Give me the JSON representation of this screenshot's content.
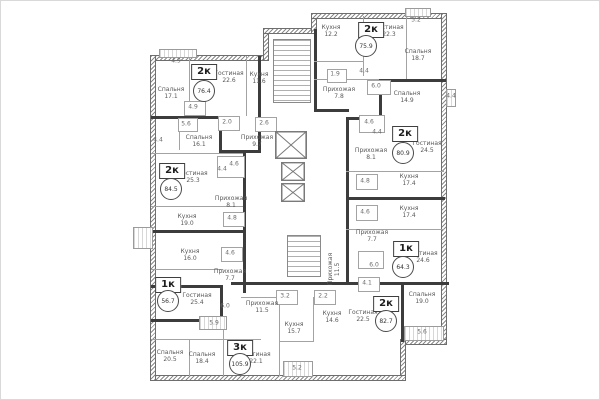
{
  "plan": {
    "type_note": "residential floor plan",
    "colors": {
      "exterior_wall": "#6e6e6e",
      "unit_boundary": "#3c3c3c",
      "interior_wall": "#a3a3a3",
      "label_text": "#595959",
      "background": "#ffffff"
    },
    "apartments": [
      {
        "type": "2к",
        "area": "76.4",
        "bx": 203,
        "by": 71,
        "cx": 203,
        "cy": 90
      },
      {
        "type": "2к",
        "area": "75.9",
        "bx": 370,
        "by": 29,
        "cx": 365,
        "cy": 45
      },
      {
        "type": "2к",
        "area": "84.5",
        "bx": 171,
        "by": 170,
        "cx": 170,
        "cy": 188
      },
      {
        "type": "2к",
        "area": "80.9",
        "bx": 404,
        "by": 133,
        "cx": 402,
        "cy": 152
      },
      {
        "type": "1к",
        "area": "56.7",
        "bx": 167,
        "by": 284,
        "cx": 167,
        "cy": 300
      },
      {
        "type": "1к",
        "area": "64.3",
        "bx": 405,
        "by": 248,
        "cx": 402,
        "cy": 266
      },
      {
        "type": "3к",
        "area": "105.9",
        "bx": 239,
        "by": 347,
        "cx": 239,
        "cy": 363
      },
      {
        "type": "2к",
        "area": "82.7",
        "bx": 385,
        "by": 303,
        "cx": 385,
        "cy": 320
      }
    ],
    "rooms": [
      {
        "name": "Спальня",
        "area": "17.1",
        "x": 170,
        "y": 93
      },
      {
        "name": "Гостиная",
        "area": "22.6",
        "x": 228,
        "y": 77
      },
      {
        "name": "Кухня",
        "area": "11.6",
        "x": 258,
        "y": 78
      },
      {
        "name": "Прихожая",
        "area": "9.7",
        "x": 256,
        "y": 141
      },
      {
        "name": "Спальня",
        "area": "16.1",
        "x": 198,
        "y": 141
      },
      {
        "name": "Гостиная",
        "area": "25.3",
        "x": 192,
        "y": 177
      },
      {
        "name": "Кухня",
        "area": "19.0",
        "x": 186,
        "y": 220
      },
      {
        "name": "Кухня",
        "area": "16.0",
        "x": 189,
        "y": 255
      },
      {
        "name": "Прихожая",
        "area": "8.1",
        "x": 230,
        "y": 202
      },
      {
        "name": "Прихожая",
        "area": "7.7",
        "x": 229,
        "y": 275
      },
      {
        "name": "Гостиная",
        "area": "25.4",
        "x": 196,
        "y": 299
      },
      {
        "name": "Спальня",
        "area": "20.5",
        "x": 169,
        "y": 356
      },
      {
        "name": "Спальня",
        "area": "18.4",
        "x": 201,
        "y": 358
      },
      {
        "name": "Гостиная",
        "area": "22.1",
        "x": 255,
        "y": 358
      },
      {
        "name": "Прихожая",
        "area": "11.5",
        "x": 261,
        "y": 307
      },
      {
        "name": "Кухня",
        "area": "15.7",
        "x": 293,
        "y": 328
      },
      {
        "name": "Кухня",
        "area": "12.2",
        "x": 330,
        "y": 31
      },
      {
        "name": "Гостиная",
        "area": "22.3",
        "x": 388,
        "y": 31
      },
      {
        "name": "Спальня",
        "area": "18.7",
        "x": 417,
        "y": 55
      },
      {
        "name": "Прихожая",
        "area": "7.8",
        "x": 338,
        "y": 93
      },
      {
        "name": "Спальня",
        "area": "14.9",
        "x": 406,
        "y": 97
      },
      {
        "name": "Гостиная",
        "area": "24.5",
        "x": 426,
        "y": 147
      },
      {
        "name": "Прихожая",
        "area": "8.1",
        "x": 370,
        "y": 154
      },
      {
        "name": "Кухня",
        "area": "17.4",
        "x": 408,
        "y": 180
      },
      {
        "name": "Кухня",
        "area": "17.4",
        "x": 408,
        "y": 212
      },
      {
        "name": "Прихожая",
        "area": "7.7",
        "x": 371,
        "y": 236
      },
      {
        "name": "Гостиная",
        "area": "24.6",
        "x": 422,
        "y": 257
      },
      {
        "name": "Кухня",
        "area": "14.6",
        "x": 331,
        "y": 317
      },
      {
        "name": "Гостиная",
        "area": "22.5",
        "x": 362,
        "y": 316
      },
      {
        "name": "Спальня",
        "area": "19.0",
        "x": 421,
        "y": 298
      },
      {
        "name": "Прихожая",
        "area": "11.5",
        "x": 334,
        "y": 268,
        "v": true
      }
    ],
    "dimensions": [
      {
        "value": "4.9",
        "x": 175,
        "y": 60
      },
      {
        "value": "4.9",
        "x": 192,
        "y": 106
      },
      {
        "value": "5.6",
        "x": 185,
        "y": 123
      },
      {
        "value": "2.0",
        "x": 226,
        "y": 121
      },
      {
        "value": "2.6",
        "x": 263,
        "y": 122
      },
      {
        "value": "4.4",
        "x": 157,
        "y": 139
      },
      {
        "value": "4.6",
        "x": 233,
        "y": 163
      },
      {
        "value": "4.4",
        "x": 221,
        "y": 168
      },
      {
        "value": "4.8",
        "x": 231,
        "y": 217
      },
      {
        "value": "4.6",
        "x": 229,
        "y": 252
      },
      {
        "value": "6.0",
        "x": 224,
        "y": 305
      },
      {
        "value": "5.9",
        "x": 213,
        "y": 322
      },
      {
        "value": "5.2",
        "x": 296,
        "y": 367
      },
      {
        "value": "3.2",
        "x": 284,
        "y": 295
      },
      {
        "value": "2.2",
        "x": 322,
        "y": 295
      },
      {
        "value": "4.1",
        "x": 366,
        "y": 282
      },
      {
        "value": "6.0",
        "x": 373,
        "y": 264
      },
      {
        "value": "4.6",
        "x": 364,
        "y": 211
      },
      {
        "value": "4.8",
        "x": 364,
        "y": 180
      },
      {
        "value": "4.4",
        "x": 376,
        "y": 131
      },
      {
        "value": "4.6",
        "x": 368,
        "y": 121
      },
      {
        "value": "6.0",
        "x": 375,
        "y": 85
      },
      {
        "value": "4.4",
        "x": 363,
        "y": 70
      },
      {
        "value": "1.9",
        "x": 334,
        "y": 73
      },
      {
        "value": "4.4",
        "x": 450,
        "y": 95
      },
      {
        "value": "5.2",
        "x": 415,
        "y": 19
      },
      {
        "value": "5.6",
        "x": 421,
        "y": 331
      }
    ]
  }
}
